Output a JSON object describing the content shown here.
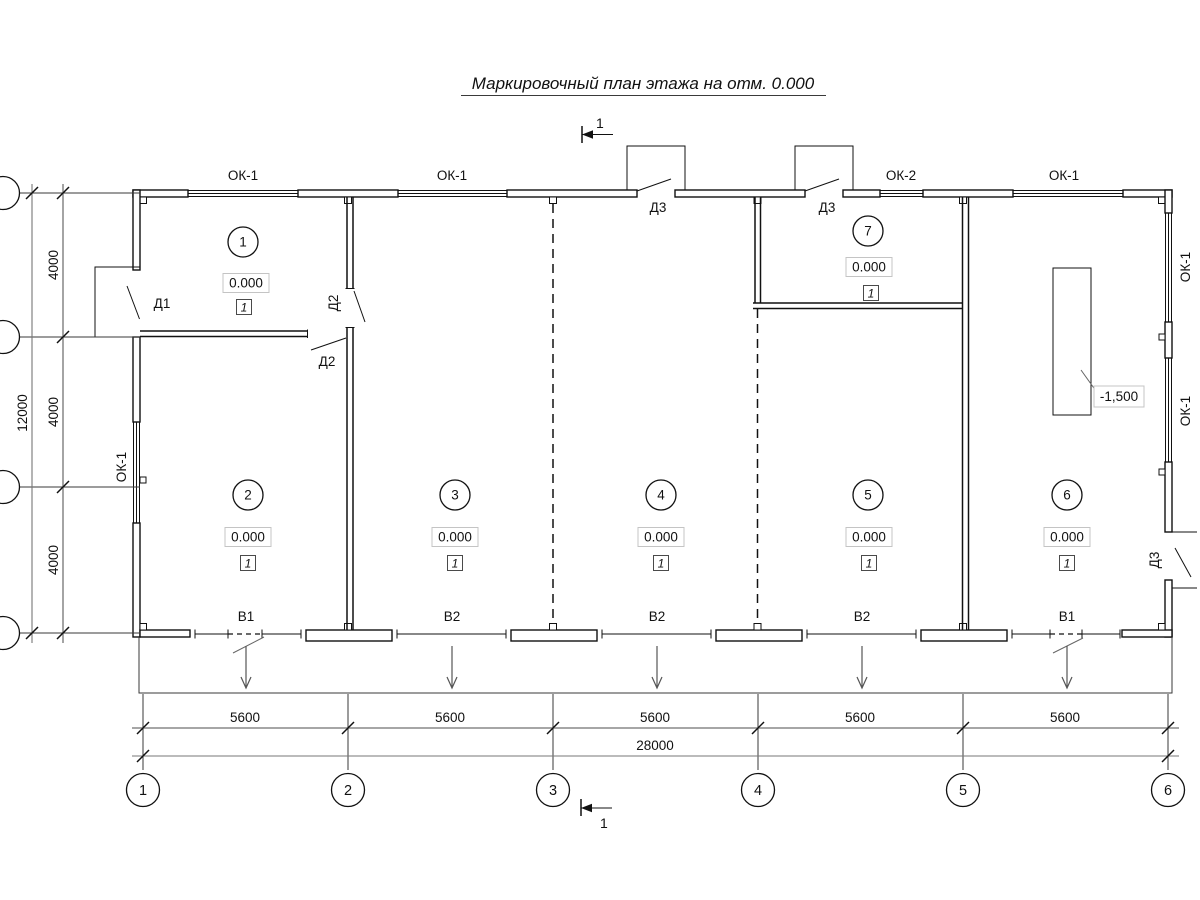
{
  "title": "Маркировочный план этажа на отм. 0.000",
  "section_marks": {
    "top": "1",
    "bottom": "1"
  },
  "windows": {
    "top_1": "ОК-1",
    "top_2": "ОК-1",
    "top_3": "ОК-2",
    "top_4": "ОК-1",
    "left_1": "ОК-1",
    "right_1": "ОК-1",
    "right_2": "ОК-1"
  },
  "doors": {
    "d1": "Д1",
    "d2_wall": "Д2",
    "d2_partition": "Д2",
    "d3_top_left": "Д3",
    "d3_top_right": "Д3",
    "d3_right": "Д3"
  },
  "rooms": [
    {
      "number": "1",
      "elevation": "0.000",
      "finish_type": "1"
    },
    {
      "number": "2",
      "elevation": "0.000",
      "finish_type": "1"
    },
    {
      "number": "3",
      "elevation": "0.000",
      "finish_type": "1"
    },
    {
      "number": "4",
      "elevation": "0.000",
      "finish_type": "1"
    },
    {
      "number": "5",
      "elevation": "0.000",
      "finish_type": "1"
    },
    {
      "number": "6",
      "elevation": "0.000",
      "finish_type": "1"
    },
    {
      "number": "7",
      "elevation": "0.000",
      "finish_type": "1"
    }
  ],
  "outlets": {
    "w1": "В1",
    "w2": "В2",
    "w3": "В2",
    "w4": "В2",
    "w5": "В1"
  },
  "pit": {
    "elevation": "-1,500"
  },
  "dimensions": {
    "bottom_spans": [
      "5600",
      "5600",
      "5600",
      "5600",
      "5600"
    ],
    "bottom_total": "28000",
    "left_spans": [
      "4000",
      "4000",
      "4000"
    ],
    "left_total": "12000"
  },
  "axes": {
    "bottom": [
      "1",
      "2",
      "3",
      "4",
      "5",
      "6"
    ]
  }
}
